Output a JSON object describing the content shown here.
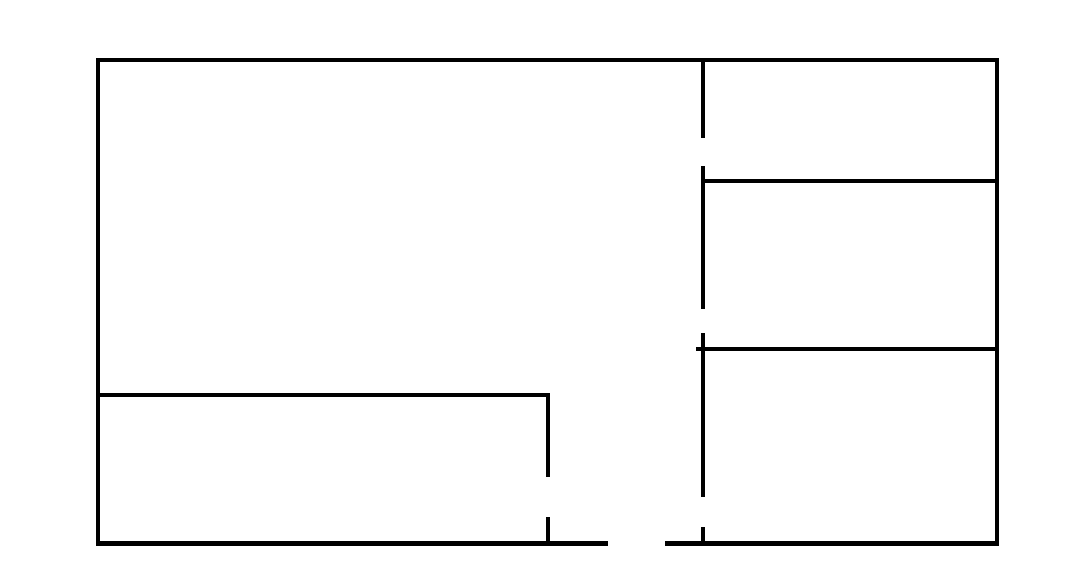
{
  "canvas": {
    "width": 1084,
    "height": 575,
    "background_color": "#ffffff",
    "stroke_color": "#000000",
    "stroke_thickness": 4
  },
  "drawing": {
    "type": "floor-plan-line-drawing",
    "description": "Hand-drawn style floor plan: outer rectangle, right-side vertical divider with three door gaps, two horizontal walls forming three rooms on the right, L-shaped interior wall at bottom-left with a door gap, and a doorway opening in the bottom outer wall",
    "rooms_count": 5,
    "walls": [
      {
        "name": "wall-outer-top",
        "x": 96,
        "y": 58,
        "w": 903,
        "h": 4
      },
      {
        "name": "wall-outer-left",
        "x": 96,
        "y": 58,
        "w": 4,
        "h": 487
      },
      {
        "name": "wall-outer-right",
        "x": 995,
        "y": 58,
        "w": 4,
        "h": 487
      },
      {
        "name": "wall-outer-bottom-left-segment",
        "x": 96,
        "y": 541,
        "w": 512,
        "h": 5
      },
      {
        "name": "wall-outer-bottom-right-segment",
        "x": 665,
        "y": 541,
        "w": 334,
        "h": 5
      },
      {
        "name": "wall-divider-segment-1",
        "x": 701,
        "y": 58,
        "w": 4,
        "h": 80
      },
      {
        "name": "wall-divider-segment-2",
        "x": 701,
        "y": 166,
        "w": 4,
        "h": 143
      },
      {
        "name": "wall-divider-segment-3",
        "x": 701,
        "y": 333,
        "w": 4,
        "h": 164
      },
      {
        "name": "wall-divider-segment-4",
        "x": 701,
        "y": 527,
        "w": 4,
        "h": 18
      },
      {
        "name": "wall-right-upper-horizontal",
        "x": 703,
        "y": 179,
        "w": 292,
        "h": 4
      },
      {
        "name": "wall-right-middle-horizontal",
        "x": 696,
        "y": 347,
        "w": 299,
        "h": 4
      },
      {
        "name": "wall-left-room-horizontal",
        "x": 96,
        "y": 393,
        "w": 454,
        "h": 4
      },
      {
        "name": "wall-interior-vertical-upper",
        "x": 546,
        "y": 393,
        "w": 4,
        "h": 84
      },
      {
        "name": "wall-interior-vertical-lower",
        "x": 546,
        "y": 517,
        "w": 4,
        "h": 28
      }
    ],
    "door_gaps": [
      {
        "name": "door-gap-divider-upper",
        "x": 701,
        "y": 138,
        "w": 4,
        "h": 28
      },
      {
        "name": "door-gap-divider-middle",
        "x": 701,
        "y": 309,
        "w": 4,
        "h": 24
      },
      {
        "name": "door-gap-divider-lower",
        "x": 701,
        "y": 497,
        "w": 4,
        "h": 30
      },
      {
        "name": "door-gap-interior-vertical",
        "x": 546,
        "y": 477,
        "w": 4,
        "h": 40
      },
      {
        "name": "door-gap-bottom-wall",
        "x": 608,
        "y": 541,
        "w": 57,
        "h": 5
      }
    ]
  }
}
